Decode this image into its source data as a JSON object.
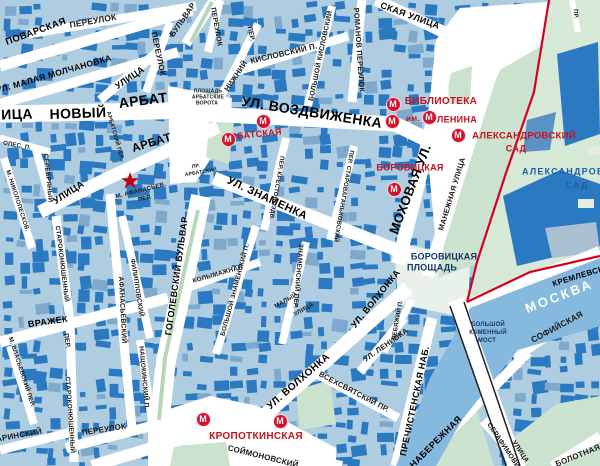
{
  "colors": {
    "block_fill": "#aecde0",
    "building": "#2b7ac1",
    "building_light": "#7ea9cd",
    "street": "#ffffff",
    "park_green": "#cbe2cf",
    "kremlin_green": "#d6e8d6",
    "river_blue": "#85bade",
    "boundary_red": "#d40022",
    "metro_red": "#d5112b",
    "metro_text_red": "#c8101f",
    "place_navy": "#16366b",
    "park_label_blue": "#1d5ea7"
  },
  "metro_letter": "М",
  "star": {
    "glyph": "★",
    "x": 130,
    "y": 181
  },
  "metro_icons": [
    {
      "x": 263,
      "y": 121
    },
    {
      "x": 228,
      "y": 139
    },
    {
      "x": 393,
      "y": 104
    },
    {
      "x": 392,
      "y": 121
    },
    {
      "x": 429,
      "y": 117
    },
    {
      "x": 458,
      "y": 135
    },
    {
      "x": 394,
      "y": 189
    },
    {
      "x": 203,
      "y": 419
    },
    {
      "x": 280,
      "y": 421
    }
  ],
  "labels": [
    {
      "t": "ПЕРЕУЛОК",
      "x": 93,
      "y": 21,
      "r": -10,
      "s": 8.5,
      "c": "st"
    },
    {
      "t": "ПОВАРСКАЯ",
      "x": 36,
      "y": 32,
      "r": -20,
      "s": 9.5,
      "c": "stb"
    },
    {
      "t": "УЛ. МАЛАЯ МОЛЧАНОВКА",
      "x": 54,
      "y": 74,
      "r": -16,
      "s": 8.5,
      "c": "stb"
    },
    {
      "t": "УЛИЦА",
      "x": 130,
      "y": 78,
      "r": -34,
      "s": 9,
      "c": "stb"
    },
    {
      "t": "ПЕРЕУЛОК",
      "x": 158,
      "y": 54,
      "r": 78,
      "s": 8,
      "c": "st"
    },
    {
      "t": "БУЛЬВАР",
      "x": 183,
      "y": 20,
      "r": -55,
      "s": 8,
      "c": "st"
    },
    {
      "t": "ПЕРЕУЛОК",
      "x": 216,
      "y": 27,
      "r": 80,
      "s": 7,
      "c": "st"
    },
    {
      "t": "ПЕР.",
      "x": 250,
      "y": 34,
      "r": 78,
      "s": 6.5,
      "c": "st"
    },
    {
      "t": "НИЖНИЙ",
      "x": 236,
      "y": 76,
      "r": -56,
      "s": 7.5,
      "c": "st"
    },
    {
      "t": "КИСЛОВСКИЙ П.",
      "x": 284,
      "y": 54,
      "r": -13,
      "s": 8,
      "c": "st"
    },
    {
      "t": "БОЛЬШОЙ КИСЛОВСКИЙ",
      "x": 321,
      "y": 56,
      "r": -78,
      "s": 7,
      "c": "st"
    },
    {
      "t": "РОМАНОВ ПЕРЕУЛОК",
      "x": 359,
      "y": 50,
      "r": 86,
      "s": 7.5,
      "c": "st"
    },
    {
      "t": "СКАЯ УЛИЦА",
      "x": 410,
      "y": 16,
      "r": 20,
      "s": 9,
      "c": "stb"
    },
    {
      "t": "УЛ. ВОЗДВИЖЕНКА",
      "x": 312,
      "y": 112,
      "r": 9,
      "s": 14,
      "c": "stb"
    },
    {
      "t": "ИЦА",
      "x": 17,
      "y": 114,
      "r": -2,
      "s": 14,
      "c": "stb"
    },
    {
      "t": "НОВЫЙ",
      "x": 78,
      "y": 113,
      "r": -2,
      "s": 14,
      "c": "stb"
    },
    {
      "t": "АРБАТ",
      "x": 143,
      "y": 100,
      "r": -7,
      "s": 14,
      "c": "stb"
    },
    {
      "t": "АРБАТ",
      "x": 152,
      "y": 144,
      "r": -17,
      "s": 11.5,
      "c": "stb"
    },
    {
      "t": "АРБАТСКИЙ ПЕР.",
      "x": 114,
      "y": 136,
      "r": 74,
      "s": 5.5,
      "c": "st"
    },
    {
      "t": "ПР.",
      "x": 196,
      "y": 167,
      "r": -10,
      "s": 5,
      "c": "st"
    },
    {
      "t": "АРБАТСКИЙ",
      "x": 201,
      "y": 173,
      "r": -10,
      "s": 5,
      "c": "st"
    },
    {
      "t": "ПЛОЩАДЬ",
      "x": 208,
      "y": 92,
      "r": 0,
      "s": 5,
      "c": "st"
    },
    {
      "t": "АРБАТСКИЕ",
      "x": 208,
      "y": 98,
      "r": 0,
      "s": 5,
      "c": "st"
    },
    {
      "t": "ВОРОТА",
      "x": 207,
      "y": 104,
      "r": 0,
      "s": 5,
      "c": "st"
    },
    {
      "t": "М. АФАНАСЬЕВ.",
      "x": 141,
      "y": 191,
      "r": -14,
      "s": 6,
      "c": "st"
    },
    {
      "t": "ПЕР.",
      "x": 145,
      "y": 199,
      "r": -14,
      "s": 6,
      "c": "st"
    },
    {
      "t": "УЛИЦА",
      "x": 69,
      "y": 193,
      "r": -33,
      "s": 9.5,
      "c": "stb"
    },
    {
      "t": "ОПЕС. П.",
      "x": 17,
      "y": 146,
      "r": 10,
      "s": 6,
      "c": "st"
    },
    {
      "t": "СЕРЕБРЯНЫЙ",
      "x": 47,
      "y": 178,
      "r": 84,
      "s": 6.5,
      "c": "st"
    },
    {
      "t": "М. НИКОЛОПЕСКОВ.",
      "x": 17,
      "y": 201,
      "r": 72,
      "s": 6,
      "c": "st"
    },
    {
      "t": "СТАРОКОНЮШЕННЫЙ",
      "x": 61,
      "y": 264,
      "r": 83,
      "s": 6.5,
      "c": "st"
    },
    {
      "t": "ВРАЖЕК",
      "x": 48,
      "y": 322,
      "r": -8,
      "s": 9,
      "c": "stb"
    },
    {
      "t": "ПЕР.",
      "x": 66,
      "y": 341,
      "r": 82,
      "s": 6.5,
      "c": "st"
    },
    {
      "t": "М. ВЛАСЬЕВСКИЙ ПЕР.",
      "x": 21,
      "y": 372,
      "r": 72,
      "s": 6,
      "c": "st"
    },
    {
      "t": "СТАРОКОНЮШЕННЫЙ",
      "x": 69,
      "y": 415,
      "r": 86,
      "s": 6.5,
      "c": "st"
    },
    {
      "t": "ПЕРЕУЛОК",
      "x": 104,
      "y": 430,
      "r": -9,
      "s": 8,
      "c": "st"
    },
    {
      "t": "ГАГАРИНСКИЙ",
      "x": 12,
      "y": 437,
      "r": -10,
      "s": 8,
      "c": "st"
    },
    {
      "t": "АФАНАСЬЕВСКИЙ",
      "x": 122,
      "y": 310,
      "r": 87,
      "s": 7,
      "c": "st"
    },
    {
      "t": "ФИЛИППОВСКИЙ",
      "x": 136,
      "y": 288,
      "r": 81,
      "s": 6.5,
      "c": "st"
    },
    {
      "t": "НАЩОКИНСКИЙ П.",
      "x": 143,
      "y": 378,
      "r": 85,
      "s": 6.5,
      "c": "st"
    },
    {
      "t": "ГОГОЛЕВСКИЙ БУЛЬВАР",
      "x": 177,
      "y": 276,
      "r": -82,
      "s": 9,
      "c": "stb"
    },
    {
      "t": "УЛ. ЗНАМЕНКА",
      "x": 267,
      "y": 199,
      "r": 25,
      "s": 11,
      "c": "stb"
    },
    {
      "t": "ПЕР. КРЕСТОВОЗДВ.",
      "x": 276,
      "y": 188,
      "r": 100,
      "s": 6,
      "c": "st"
    },
    {
      "t": "ПЕР. СТАРОВАГАНЬКОВСКИЙ",
      "x": 343,
      "y": 196,
      "r": 100,
      "s": 6,
      "c": "st"
    },
    {
      "t": "МОХОВАЯ УЛ.",
      "x": 410,
      "y": 189,
      "r": -69,
      "s": 13,
      "c": "stb"
    },
    {
      "t": "МАНЕЖНАЯ УЛИЦА",
      "x": 452,
      "y": 194,
      "r": -73,
      "s": 7.5,
      "c": "st"
    },
    {
      "t": "УЛ. ВОЛХОНКА",
      "x": 376,
      "y": 299,
      "r": -51,
      "s": 9,
      "c": "stb"
    },
    {
      "t": "УЛ. ЛЕНИВКА",
      "x": 386,
      "y": 345,
      "r": -35,
      "s": 7.5,
      "c": "st"
    },
    {
      "t": "ЛЕБЯЖИЙ П.",
      "x": 398,
      "y": 320,
      "r": -80,
      "s": 6,
      "c": "st"
    },
    {
      "t": "УЛ. ВОЛХОНКА",
      "x": 299,
      "y": 382,
      "r": -41,
      "s": 10,
      "c": "stb"
    },
    {
      "t": "ВСЕХСВЯТСКИЙ ПР.",
      "x": 354,
      "y": 392,
      "r": 28,
      "s": 7.5,
      "c": "st"
    },
    {
      "t": "ПРЕЧИСТЕНСКАЯ НАБ.",
      "x": 415,
      "y": 401,
      "r": -78,
      "s": 9,
      "c": "stb"
    },
    {
      "t": "НАБЕРЕЖНАЯ",
      "x": 436,
      "y": 442,
      "r": -45,
      "s": 9,
      "c": "stb"
    },
    {
      "t": "СОЙМОНОВСКИЙ",
      "x": 263,
      "y": 457,
      "r": 14,
      "s": 8,
      "c": "st"
    },
    {
      "t": "КРЕМЛЕВСКАЯ",
      "x": 584,
      "y": 275,
      "r": -17,
      "s": 8,
      "c": "stb"
    },
    {
      "t": "СОФИЙСКАЯ",
      "x": 557,
      "y": 327,
      "r": -28,
      "s": 8.5,
      "c": "st"
    },
    {
      "t": "СЕРАФИМОВИЧА",
      "x": 506,
      "y": 450,
      "r": 56,
      "s": 7,
      "c": "st"
    },
    {
      "t": "УЛИЦА",
      "x": 520,
      "y": 452,
      "r": 56,
      "s": 7,
      "c": "st"
    },
    {
      "t": "БОЛОТНАЯ",
      "x": 578,
      "y": 456,
      "r": -22,
      "s": 8,
      "c": "st"
    },
    {
      "t": "КОЛЫМАЖНАЯ",
      "x": 218,
      "y": 275,
      "r": -16,
      "s": 6.5,
      "c": "st"
    },
    {
      "t": "БОЛЬШОЙ ЗНАМЕНСКИЙ П.",
      "x": 236,
      "y": 290,
      "r": -75,
      "s": 6.5,
      "c": "st"
    },
    {
      "t": "ЗНАМЕНСКИЙ ПЕР.",
      "x": 297,
      "y": 276,
      "r": 95,
      "s": 6.5,
      "c": "st"
    },
    {
      "t": "МАЛЫЙ",
      "x": 286,
      "y": 301,
      "r": -30,
      "s": 6,
      "c": "st"
    },
    {
      "t": "УЛИЦА",
      "x": 304,
      "y": 310,
      "r": -30,
      "s": 6,
      "c": "st"
    },
    {
      "t": "ПР.",
      "x": 575,
      "y": 14,
      "r": 85,
      "s": 6,
      "c": "st"
    },
    {
      "t": "БОРОВИЦКАЯ",
      "x": 444,
      "y": 257,
      "r": 0,
      "s": 9,
      "c": "place"
    },
    {
      "t": "ПЛОЩАДЬ",
      "x": 432,
      "y": 268,
      "r": 0,
      "s": 9,
      "c": "place"
    },
    {
      "t": "БОЛЬШОЙ",
      "x": 488,
      "y": 325,
      "r": 0,
      "s": 6,
      "c": "place"
    },
    {
      "t": "КАМЕННЫЙ",
      "x": 488,
      "y": 333,
      "r": 0,
      "s": 6,
      "c": "place"
    },
    {
      "t": "МОСТ",
      "x": 487,
      "y": 341,
      "r": 0,
      "s": 6,
      "c": "place"
    },
    {
      "t": "АЛЕКСАНДРОВСКИЙ",
      "x": 578,
      "y": 172,
      "r": 0,
      "s": 9,
      "c": "park"
    },
    {
      "t": "САД",
      "x": 577,
      "y": 186,
      "r": 0,
      "s": 9,
      "c": "park"
    },
    {
      "t": "МОСКВА",
      "x": 559,
      "y": 296,
      "r": -21,
      "s": 13,
      "c": "river"
    },
    {
      "t": "АРБАТСКАЯ",
      "x": 253,
      "y": 135,
      "r": -6,
      "s": 9,
      "c": "metro"
    },
    {
      "t": "БИБЛИОТЕКА",
      "x": 441,
      "y": 102,
      "r": 0,
      "s": 10,
      "c": "metro"
    },
    {
      "t": "им.",
      "x": 413,
      "y": 119,
      "r": 0,
      "s": 8,
      "c": "metro"
    },
    {
      "t": "ЛЕНИНА",
      "x": 457,
      "y": 120,
      "r": 0,
      "s": 9,
      "c": "metro"
    },
    {
      "t": "АЛЕКСАНДРОВСКИЙ",
      "x": 524,
      "y": 136,
      "r": 0,
      "s": 9.5,
      "c": "metro"
    },
    {
      "t": "САД",
      "x": 516,
      "y": 149,
      "r": 0,
      "s": 9,
      "c": "metro"
    },
    {
      "t": "БОРОВИЦКАЯ",
      "x": 410,
      "y": 168,
      "r": 0,
      "s": 9,
      "c": "metro"
    },
    {
      "t": "КРОПОТКИНСКАЯ",
      "x": 256,
      "y": 437,
      "r": 0,
      "s": 10,
      "c": "metro"
    }
  ]
}
